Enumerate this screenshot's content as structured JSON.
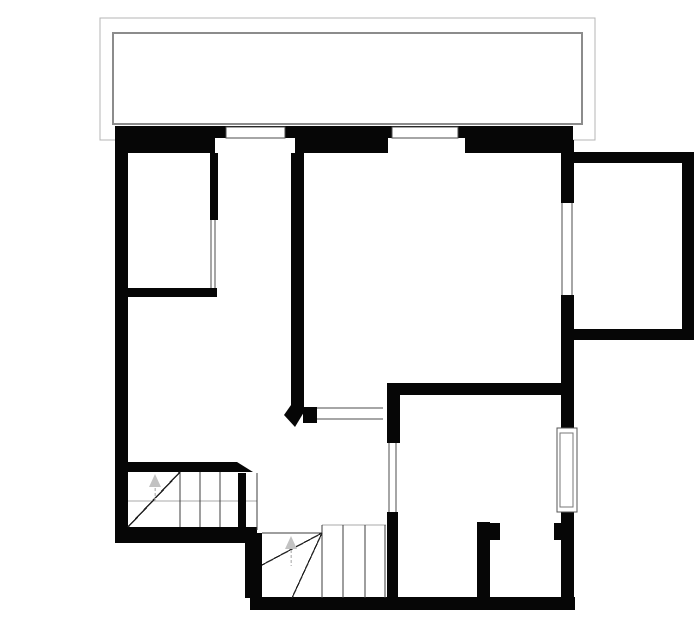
{
  "plan": {
    "canvas": {
      "width": 700,
      "height": 644,
      "background": "#ffffff"
    },
    "colors": {
      "wall": "#060606",
      "balcony_outer_line": "#b4b4b4",
      "balcony_inner_line": "#8c8c8c",
      "window_frame_line": "#4d4d4d",
      "stair_tread_line": "#3d3d3d",
      "stair_winder_line": "#222222",
      "guide_line": "#a8a8a8",
      "direction_arrow": "#c2c2c2",
      "floor_fill": "#ffffff"
    },
    "shapes": [
      {
        "type": "rect",
        "name": "balcony-outline-outer",
        "x": 100,
        "y": 18,
        "w": 495,
        "h": 122,
        "fill": "none",
        "stroke": "#b4b4b4",
        "sw": 1
      },
      {
        "type": "rect",
        "name": "balcony-outline-inner",
        "x": 113,
        "y": 33,
        "w": 469,
        "h": 91,
        "fill": "none",
        "stroke": "#8c8c8c",
        "sw": 2
      },
      {
        "type": "line",
        "name": "stair-upper-guide-line",
        "x1": 128,
        "y1": 501,
        "x2": 257,
        "y2": 501,
        "stroke": "#a8a8a8",
        "sw": 1
      },
      {
        "type": "rect",
        "name": "wall-top-exterior",
        "x": 115,
        "y": 126,
        "w": 458,
        "h": 27,
        "fill": "#060606"
      },
      {
        "type": "rect",
        "name": "wall-left-exterior",
        "x": 115,
        "y": 126,
        "w": 13,
        "h": 417,
        "fill": "#060606"
      },
      {
        "type": "rect",
        "name": "wall-room1-right",
        "x": 210,
        "y": 140,
        "w": 8,
        "h": 80,
        "fill": "#060606"
      },
      {
        "type": "rect",
        "name": "wall-room1-bottom",
        "x": 128,
        "y": 288,
        "w": 89,
        "h": 9,
        "fill": "#060606"
      },
      {
        "type": "rect",
        "name": "wall-central",
        "x": 291,
        "y": 140,
        "w": 13,
        "h": 267,
        "fill": "#060606"
      },
      {
        "type": "polygon",
        "name": "wall-central-splayed-end",
        "points": "291,405 304,405 304,412 295,427 284,415",
        "fill": "#060606"
      },
      {
        "type": "rect",
        "name": "wall-hall-window-cap",
        "x": 303,
        "y": 407,
        "w": 14,
        "h": 16,
        "fill": "#060606"
      },
      {
        "type": "rect",
        "name": "wall-roomD-left-jamb",
        "x": 387,
        "y": 383,
        "w": 13,
        "h": 60,
        "fill": "#060606"
      },
      {
        "type": "rect",
        "name": "wall-roomD-top",
        "x": 387,
        "y": 383,
        "w": 187,
        "h": 12,
        "fill": "#060606"
      },
      {
        "type": "rect",
        "name": "wall-roomD-left-lower",
        "x": 387,
        "y": 512,
        "w": 11,
        "h": 95,
        "fill": "#060606"
      },
      {
        "type": "rect",
        "name": "wall-right-upper",
        "x": 561,
        "y": 140,
        "w": 13,
        "h": 63,
        "fill": "#060606"
      },
      {
        "type": "rect",
        "name": "wall-right-middle",
        "x": 561,
        "y": 295,
        "w": 13,
        "h": 133,
        "fill": "#060606"
      },
      {
        "type": "rect",
        "name": "wall-right-lower",
        "x": 561,
        "y": 510,
        "w": 13,
        "h": 100,
        "fill": "#060606"
      },
      {
        "type": "rect",
        "name": "wall-extension-top",
        "x": 563,
        "y": 152,
        "w": 131,
        "h": 11,
        "fill": "#060606"
      },
      {
        "type": "rect",
        "name": "wall-extension-right",
        "x": 682,
        "y": 152,
        "w": 12,
        "h": 188,
        "fill": "#060606"
      },
      {
        "type": "rect",
        "name": "wall-extension-bottom",
        "x": 563,
        "y": 329,
        "w": 131,
        "h": 11,
        "fill": "#060606"
      },
      {
        "type": "rect",
        "name": "wall-stair-top",
        "x": 128,
        "y": 462,
        "w": 109,
        "h": 10,
        "fill": "#060606"
      },
      {
        "type": "polygon",
        "name": "wall-stair-top-chamfer",
        "points": "237,462 253,472 237,472",
        "fill": "#060606"
      },
      {
        "type": "rect",
        "name": "wall-bottom-left",
        "x": 115,
        "y": 527,
        "w": 142,
        "h": 16,
        "fill": "#060606"
      },
      {
        "type": "rect",
        "name": "wall-step-vertical",
        "x": 245,
        "y": 533,
        "w": 17,
        "h": 65,
        "fill": "#060606"
      },
      {
        "type": "rect",
        "name": "wall-bottom-right",
        "x": 250,
        "y": 597,
        "w": 325,
        "h": 13,
        "fill": "#060606"
      },
      {
        "type": "rect",
        "name": "wall-stair-newel-bar",
        "x": 238,
        "y": 473,
        "w": 8,
        "h": 57,
        "fill": "#060606"
      },
      {
        "type": "rect",
        "name": "wall-roomD-door-stub",
        "x": 477,
        "y": 522,
        "w": 13,
        "h": 75,
        "fill": "#060606"
      },
      {
        "type": "rect",
        "name": "wall-roomD-door-nub-left",
        "x": 490,
        "y": 523,
        "w": 10,
        "h": 17,
        "fill": "#060606"
      },
      {
        "type": "rect",
        "name": "wall-roomD-door-nub-right",
        "x": 554,
        "y": 523,
        "w": 8,
        "h": 17,
        "fill": "#060606"
      },
      {
        "type": "rect",
        "name": "window-top-1-recess",
        "x": 215,
        "y": 138,
        "w": 80,
        "h": 15,
        "fill": "#ffffff"
      },
      {
        "type": "rect",
        "name": "window-top-2-recess",
        "x": 388,
        "y": 138,
        "w": 77,
        "h": 15,
        "fill": "#ffffff"
      },
      {
        "type": "rect",
        "name": "window-top-1-frame",
        "x": 226,
        "y": 127,
        "w": 59,
        "h": 11,
        "fill": "#ffffff",
        "stroke": "#4d4d4d",
        "sw": 1
      },
      {
        "type": "rect",
        "name": "window-top-2-frame",
        "x": 392,
        "y": 127,
        "w": 66,
        "h": 11,
        "fill": "#ffffff",
        "stroke": "#4d4d4d",
        "sw": 1
      },
      {
        "type": "rect",
        "name": "window-right-roomD-frame-outer",
        "x": 557,
        "y": 428,
        "w": 20,
        "h": 84,
        "fill": "#ffffff",
        "stroke": "#555555",
        "sw": 1
      },
      {
        "type": "rect",
        "name": "window-right-roomD-frame-inner",
        "x": 560,
        "y": 433,
        "w": 13,
        "h": 74,
        "fill": "none",
        "stroke": "#777777",
        "sw": 1
      },
      {
        "type": "line",
        "name": "opening-room1-line-1",
        "x1": 211,
        "y1": 220,
        "x2": 211,
        "y2": 288,
        "stroke": "#4d4d4d",
        "sw": 1
      },
      {
        "type": "line",
        "name": "opening-room1-line-2",
        "x1": 215,
        "y1": 220,
        "x2": 215,
        "y2": 288,
        "stroke": "#4d4d4d",
        "sw": 1
      },
      {
        "type": "line",
        "name": "window-hall-line-top",
        "x1": 317,
        "y1": 408,
        "x2": 383,
        "y2": 408,
        "stroke": "#4d4d4d",
        "sw": 1
      },
      {
        "type": "line",
        "name": "window-hall-line-bottom",
        "x1": 317,
        "y1": 419,
        "x2": 383,
        "y2": 419,
        "stroke": "#4d4d4d",
        "sw": 1
      },
      {
        "type": "line",
        "name": "opening-roomD-line-1",
        "x1": 389,
        "y1": 443,
        "x2": 389,
        "y2": 512,
        "stroke": "#4d4d4d",
        "sw": 1
      },
      {
        "type": "line",
        "name": "opening-roomD-line-2",
        "x1": 396,
        "y1": 443,
        "x2": 396,
        "y2": 512,
        "stroke": "#4d4d4d",
        "sw": 1
      },
      {
        "type": "line",
        "name": "window-extension-line-1",
        "x1": 562,
        "y1": 203,
        "x2": 562,
        "y2": 295,
        "stroke": "#4d4d4d",
        "sw": 1
      },
      {
        "type": "line",
        "name": "window-extension-line-2",
        "x1": 572,
        "y1": 203,
        "x2": 572,
        "y2": 295,
        "stroke": "#4d4d4d",
        "sw": 1
      },
      {
        "type": "line",
        "name": "stair-upper-tread-1",
        "x1": 180,
        "y1": 472,
        "x2": 180,
        "y2": 527,
        "stroke": "#3d3d3d",
        "sw": 1
      },
      {
        "type": "line",
        "name": "stair-upper-tread-2",
        "x1": 200,
        "y1": 472,
        "x2": 200,
        "y2": 527,
        "stroke": "#3d3d3d",
        "sw": 1
      },
      {
        "type": "line",
        "name": "stair-upper-tread-3",
        "x1": 220,
        "y1": 472,
        "x2": 220,
        "y2": 527,
        "stroke": "#3d3d3d",
        "sw": 1
      },
      {
        "type": "line",
        "name": "stair-upper-tread-4",
        "x1": 257,
        "y1": 473,
        "x2": 257,
        "y2": 530,
        "stroke": "#3d3d3d",
        "sw": 1
      },
      {
        "type": "line",
        "name": "stair-upper-winder-diagonal",
        "x1": 128,
        "y1": 527,
        "x2": 180,
        "y2": 472,
        "stroke": "#222222",
        "sw": 1.5
      },
      {
        "type": "line",
        "name": "stair-lower-top-edge",
        "x1": 262,
        "y1": 533,
        "x2": 322,
        "y2": 533,
        "stroke": "#3d3d3d",
        "sw": 1
      },
      {
        "type": "line",
        "name": "stair-lower-guide-line",
        "x1": 322,
        "y1": 525,
        "x2": 386,
        "y2": 525,
        "stroke": "#a8a8a8",
        "sw": 1
      },
      {
        "type": "line",
        "name": "stair-lower-tread-1",
        "x1": 322,
        "y1": 525,
        "x2": 322,
        "y2": 598,
        "stroke": "#3d3d3d",
        "sw": 1
      },
      {
        "type": "line",
        "name": "stair-lower-tread-2",
        "x1": 343,
        "y1": 525,
        "x2": 343,
        "y2": 598,
        "stroke": "#3d3d3d",
        "sw": 1
      },
      {
        "type": "line",
        "name": "stair-lower-tread-3",
        "x1": 365,
        "y1": 525,
        "x2": 365,
        "y2": 598,
        "stroke": "#3d3d3d",
        "sw": 1
      },
      {
        "type": "line",
        "name": "stair-lower-tread-4",
        "x1": 385,
        "y1": 525,
        "x2": 385,
        "y2": 598,
        "stroke": "#3d3d3d",
        "sw": 1
      },
      {
        "type": "line",
        "name": "stair-lower-winder-diagonal-1",
        "x1": 322,
        "y1": 533,
        "x2": 262,
        "y2": 565,
        "stroke": "#222222",
        "sw": 1.3
      },
      {
        "type": "line",
        "name": "stair-lower-winder-diagonal-2",
        "x1": 322,
        "y1": 533,
        "x2": 292,
        "y2": 598,
        "stroke": "#222222",
        "sw": 1.3
      },
      {
        "type": "polygon",
        "name": "stair-upper-up-arrow-head",
        "points": "155,474 149,487 161,487",
        "fill": "#c2c2c2"
      },
      {
        "type": "line",
        "name": "stair-upper-up-arrow-stem",
        "x1": 155,
        "y1": 488,
        "x2": 155,
        "y2": 501,
        "stroke": "#c2c2c2",
        "sw": 1.5,
        "dash": "3,2"
      },
      {
        "type": "polygon",
        "name": "stair-lower-up-arrow-head",
        "points": "291,536 285,549 297,549",
        "fill": "#c2c2c2"
      },
      {
        "type": "line",
        "name": "stair-lower-up-arrow-stem",
        "x1": 291,
        "y1": 550,
        "x2": 291,
        "y2": 566,
        "stroke": "#c2c2c2",
        "sw": 1.5,
        "dash": "3,2"
      }
    ]
  }
}
